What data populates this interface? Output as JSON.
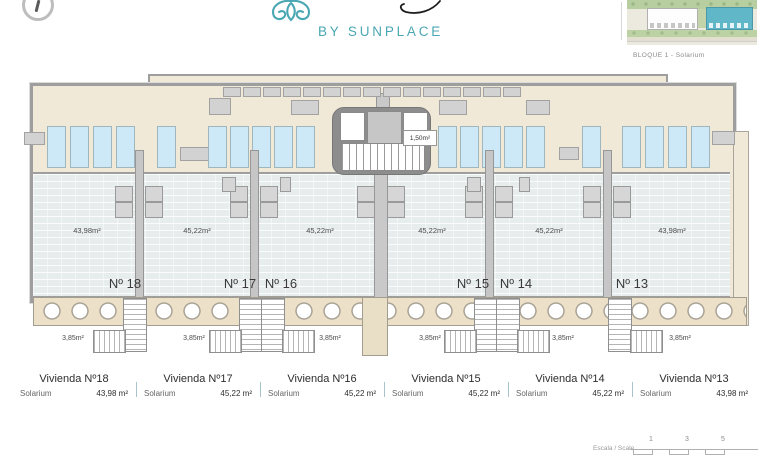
{
  "header": {
    "logo_text": "BY SUNPLACE",
    "site_plan_caption": "BLOQUE 1 - Solarium"
  },
  "plan": {
    "core_label": "1,50m²",
    "units": [
      {
        "number": "Nº 18",
        "area": "43,98m²",
        "stair_area": "3,85m²"
      },
      {
        "number": "Nº 17",
        "area": "45,22m²",
        "stair_area": "3,85m²"
      },
      {
        "number": "Nº 16",
        "area": "45,22m²",
        "stair_area": "3,85m²"
      },
      {
        "number": "Nº 15",
        "area": "45,22m²",
        "stair_area": "3,85m²"
      },
      {
        "number": "Nº 14",
        "area": "45,22m²",
        "stair_area": "3,85m²"
      },
      {
        "number": "Nº 13",
        "area": "43,98m²",
        "stair_area": "3,85m²"
      }
    ]
  },
  "legend": {
    "rows": [
      {
        "title": "Vivienda Nº18",
        "label": "Solarium",
        "value": "43,98 m²"
      },
      {
        "title": "Vivienda Nº17",
        "label": "Solarium",
        "value": "45,22 m²"
      },
      {
        "title": "Vivienda Nº16",
        "label": "Solarium",
        "value": "45,22 m²"
      },
      {
        "title": "Vivienda Nº15",
        "label": "Solarium",
        "value": "45,22 m²"
      },
      {
        "title": "Vivienda Nº14",
        "label": "Solarium",
        "value": "45,22 m²"
      },
      {
        "title": "Vivienda Nº13",
        "label": "Solarium",
        "value": "43,98 m²"
      }
    ]
  },
  "scale_bar": {
    "label": "Escala / Scale",
    "ticks": [
      "1",
      "3",
      "5"
    ]
  },
  "colors": {
    "accent_teal": "#4ba7b3",
    "deck_beige": "#f1e9d8",
    "tile_floor": "#e6edec",
    "lounger_blue": "#cde9f7",
    "site_building_teal": "#5fb7c8"
  }
}
